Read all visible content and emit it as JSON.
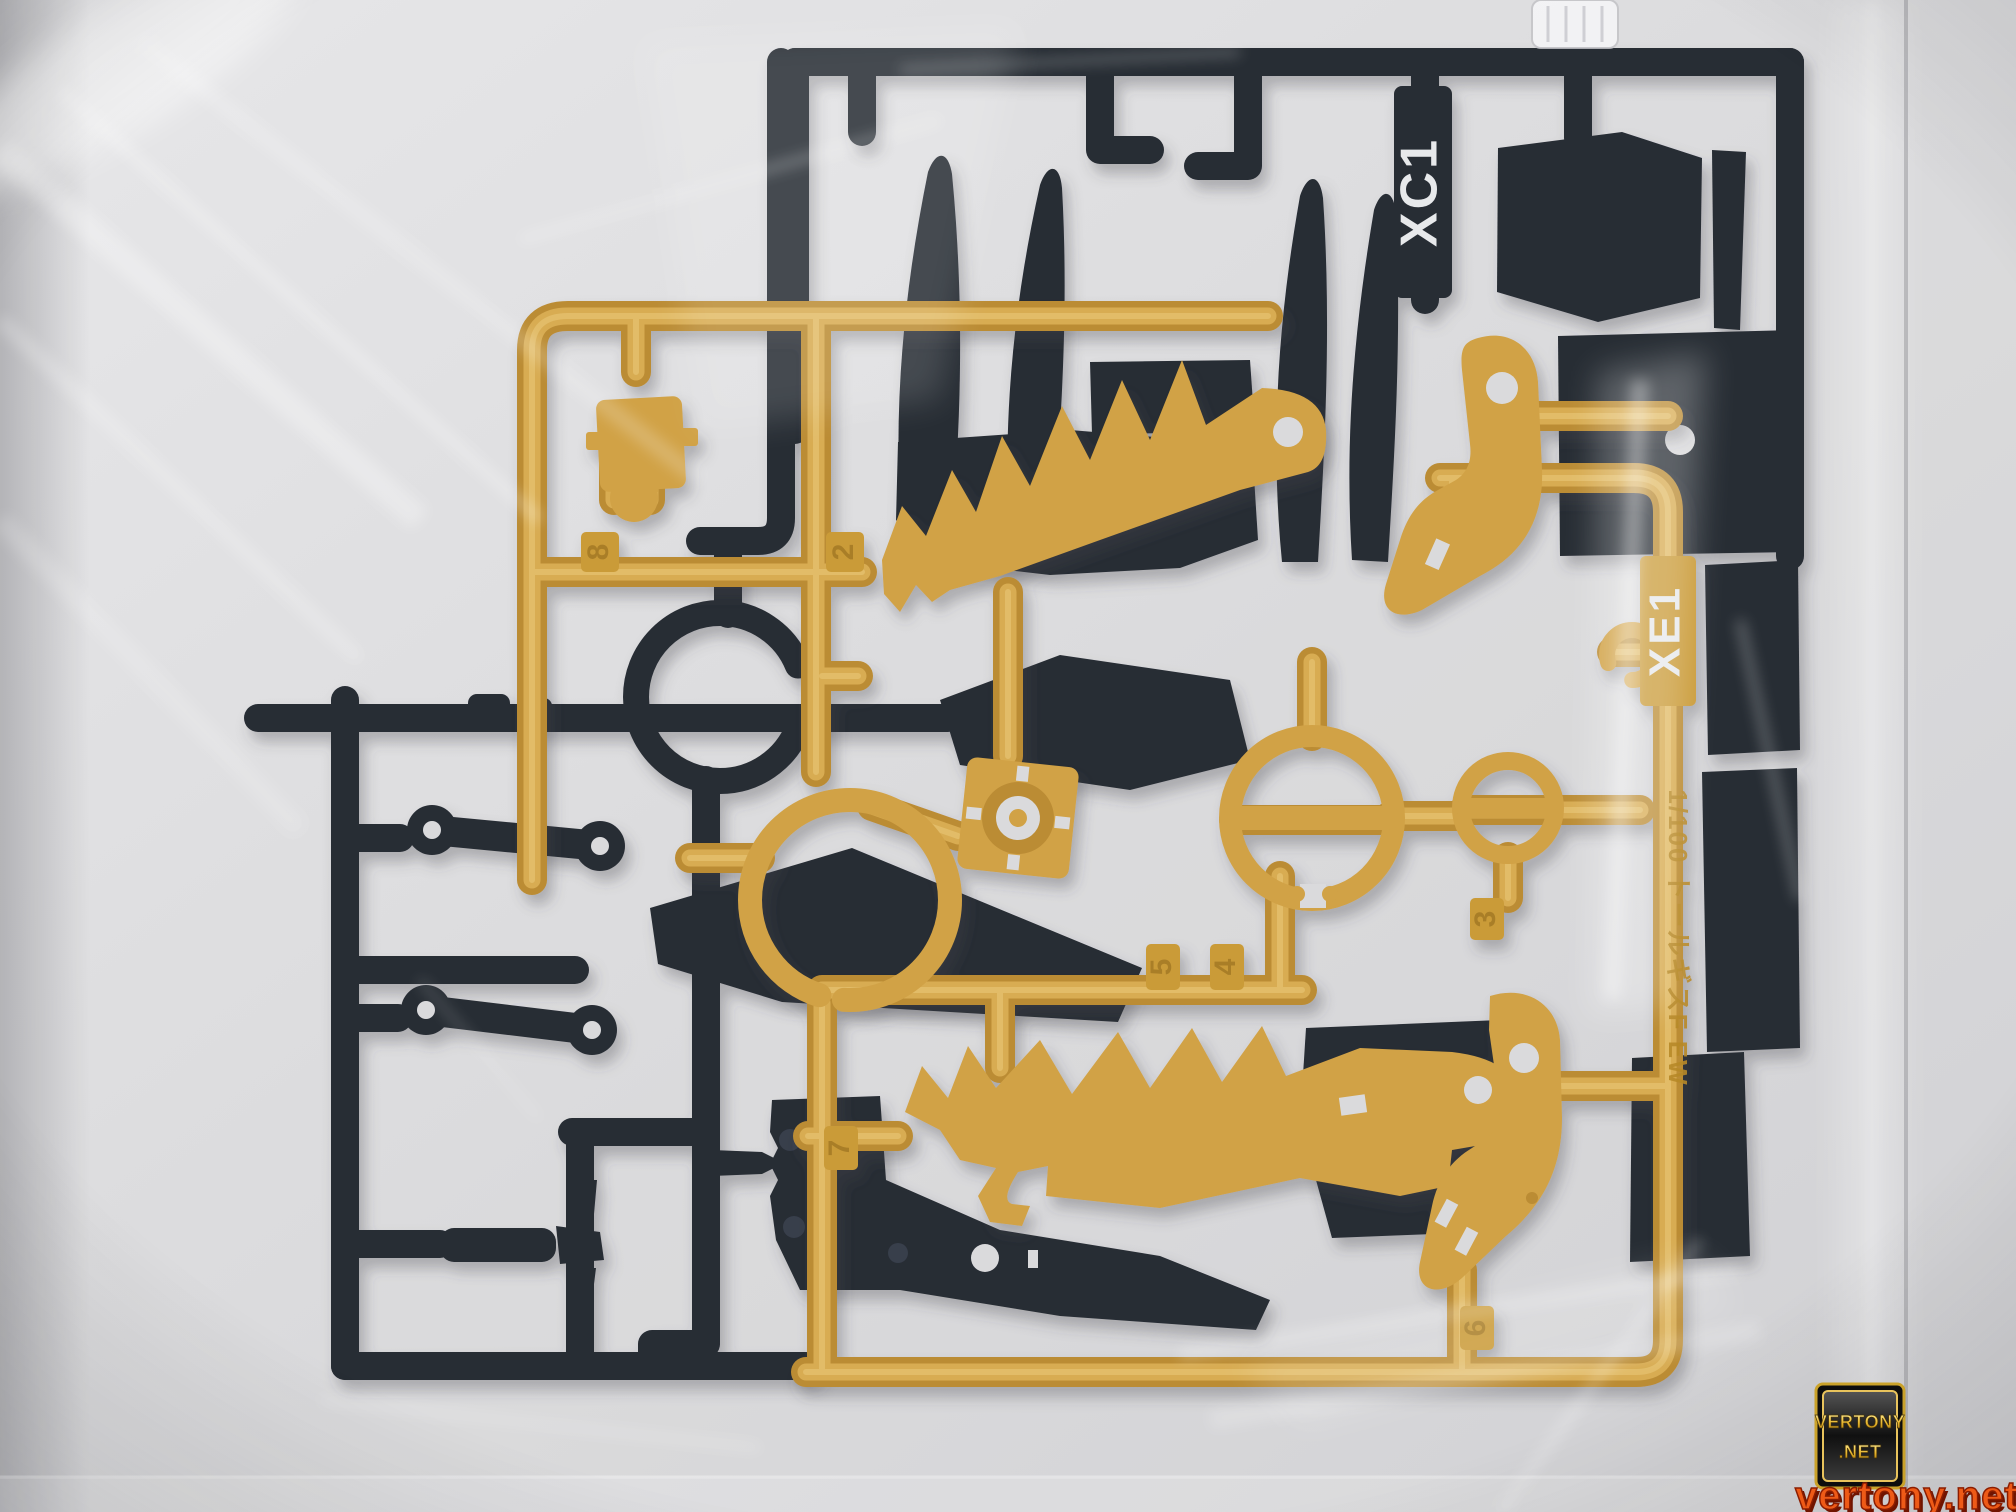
{
  "runners": {
    "black_runner": {
      "code": "XC1"
    },
    "gold_runner": {
      "code": "XE1",
      "molded_label": "1/100 トールギスF EW",
      "part_numbers": {
        "p2": "2",
        "p3": "3",
        "p4": "4",
        "p5": "5",
        "p6": "6",
        "p7": "7",
        "p8": "8"
      }
    }
  },
  "watermark": {
    "badge_line1": "VERTONY",
    "badge_line2": ".NET",
    "url_text": "vertony.net"
  },
  "colors": {
    "gold_plastic": "#cf9d3c",
    "gold_shadow": "#b8862b",
    "gold_highlight": "#dcae52",
    "black_plastic": "#1c212b",
    "bag_background": "#d9d9db",
    "watermark_orange": "#ee5a17",
    "watermark_gold": "#f2cc4e"
  }
}
